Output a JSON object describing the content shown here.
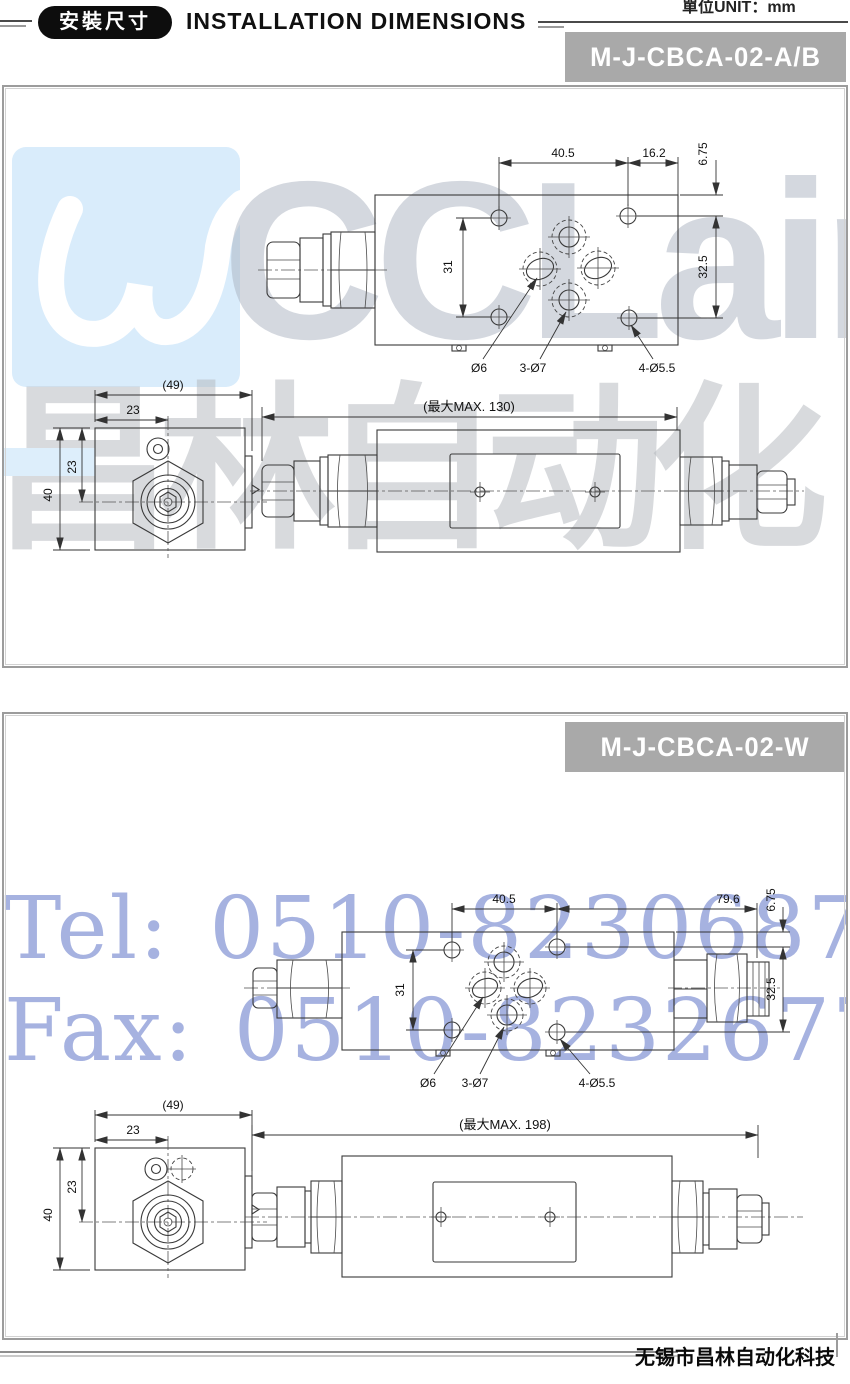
{
  "header": {
    "unit_label": "單位UNIT：mm",
    "badge_label": "安裝尺寸",
    "title": "INSTALLATION DIMENSIONS"
  },
  "watermarks": {
    "logo_text": "CCLair",
    "cn_text": "昌林自动化",
    "tel_text": "Tel: 0510-82306871",
    "fax_text": "Fax: 0510-82326771",
    "colors": {
      "logo_box_blue": "#d9ecfb",
      "gray_text": "#c3c9d3",
      "blue_text": "#9fadde",
      "banner_gray": "#a9a9a9"
    }
  },
  "footer": {
    "company": "无锡市昌林自动化科技"
  },
  "sections": [
    {
      "model": "M-J-CBCA-02-A/B",
      "top_view": {
        "dim_hole_span": "40.5",
        "dim_edge": "16.2",
        "dim_top_offset": "6.75",
        "dim_side_span": "32.5",
        "dim_left_span": "31",
        "port_label": "Ø6",
        "ports3_label": "3-Ø7",
        "corner_label": "4-Ø5.5"
      },
      "end_view": {
        "dim_overall_ref": "(49)",
        "dim_center_x": "23",
        "dim_center_y": "23",
        "dim_height": "40"
      },
      "side_view": {
        "dim_max_length": "(最大MAX. 130)"
      }
    },
    {
      "model": "M-J-CBCA-02-W",
      "top_view": {
        "dim_hole_span": "40.5",
        "dim_edge": "79.6",
        "dim_top_offset": "6.75",
        "dim_side_span": "32.5",
        "dim_left_span": "31",
        "port_label": "Ø6",
        "ports3_label": "3-Ø7",
        "corner_label": "4-Ø5.5"
      },
      "end_view": {
        "dim_overall_ref": "(49)",
        "dim_center_x": "23",
        "dim_center_y": "23",
        "dim_height": "40"
      },
      "side_view": {
        "dim_max_length": "(最大MAX. 198)"
      }
    }
  ]
}
